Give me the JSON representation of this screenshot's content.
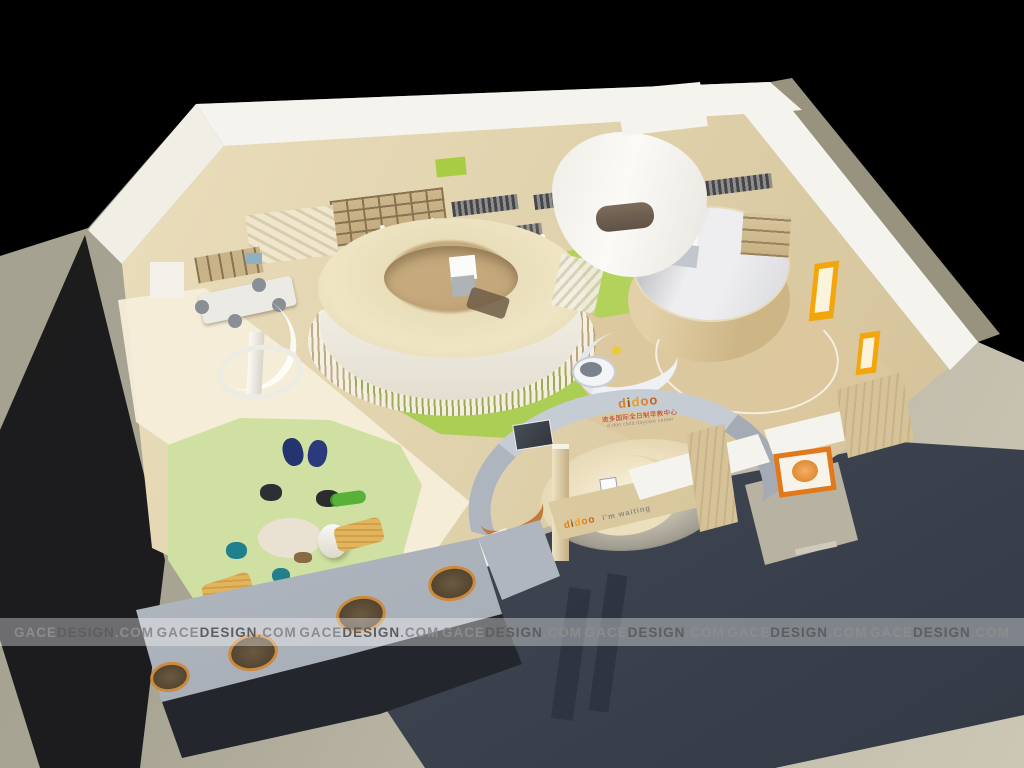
{
  "scene": {
    "type": "3d-architectural-rendering",
    "description": "aerial cutaway rendering of a children's education center interior on a gray studio base with black background",
    "brand": {
      "name": "didoo",
      "letters": [
        "d",
        "i",
        "d",
        "o",
        "o"
      ],
      "letter_colors": [
        "#e07f1e",
        "#8a5a16",
        "#f09d1c",
        "#e07f1e",
        "#c9641a"
      ],
      "wall_subtitle_cn": "迪多国际全日制早教中心",
      "wall_subtitle_en": "d-doo child daycare center",
      "desk_tagline": "i'm waiting"
    },
    "watermark": {
      "text": "GACEDESIGN.COM",
      "parts": [
        "GACE",
        "DESIGN",
        ".COM"
      ],
      "count": 7,
      "color": "#6f6f6f"
    },
    "palette": {
      "bg": "#000000",
      "slab1": "#a5a191",
      "slab2": "#ccc7b5",
      "shadow": "#3f4551",
      "shadow2": "#23262c",
      "wallWhite": "#f5f3ed",
      "floor1": "#ecdfbe",
      "floor2": "#d3c096",
      "walkway": "#f5eed9",
      "ringCream": "#efe5c4",
      "ringHole": "#c2a679",
      "wood": "#d5c194",
      "drumTop": "#eeeef1",
      "playGreen": "#cfe0a2",
      "brightGreen": "#abce55",
      "grayWall": "#b9bfc8",
      "portholeRim": "#cb8a3c",
      "navy": "#24346e",
      "teal": "#1f7f8c",
      "bagDark": "#2e2f34",
      "lounger": "#e2b45c",
      "croc": "#58b23a",
      "orange": "#e0781c",
      "yellow": "#f3a60c",
      "benchOrange": "#c27a3c",
      "tvDark": "#32373e",
      "wmText": "#6f6f6f",
      "subtitleRed": "#b5372b"
    }
  }
}
